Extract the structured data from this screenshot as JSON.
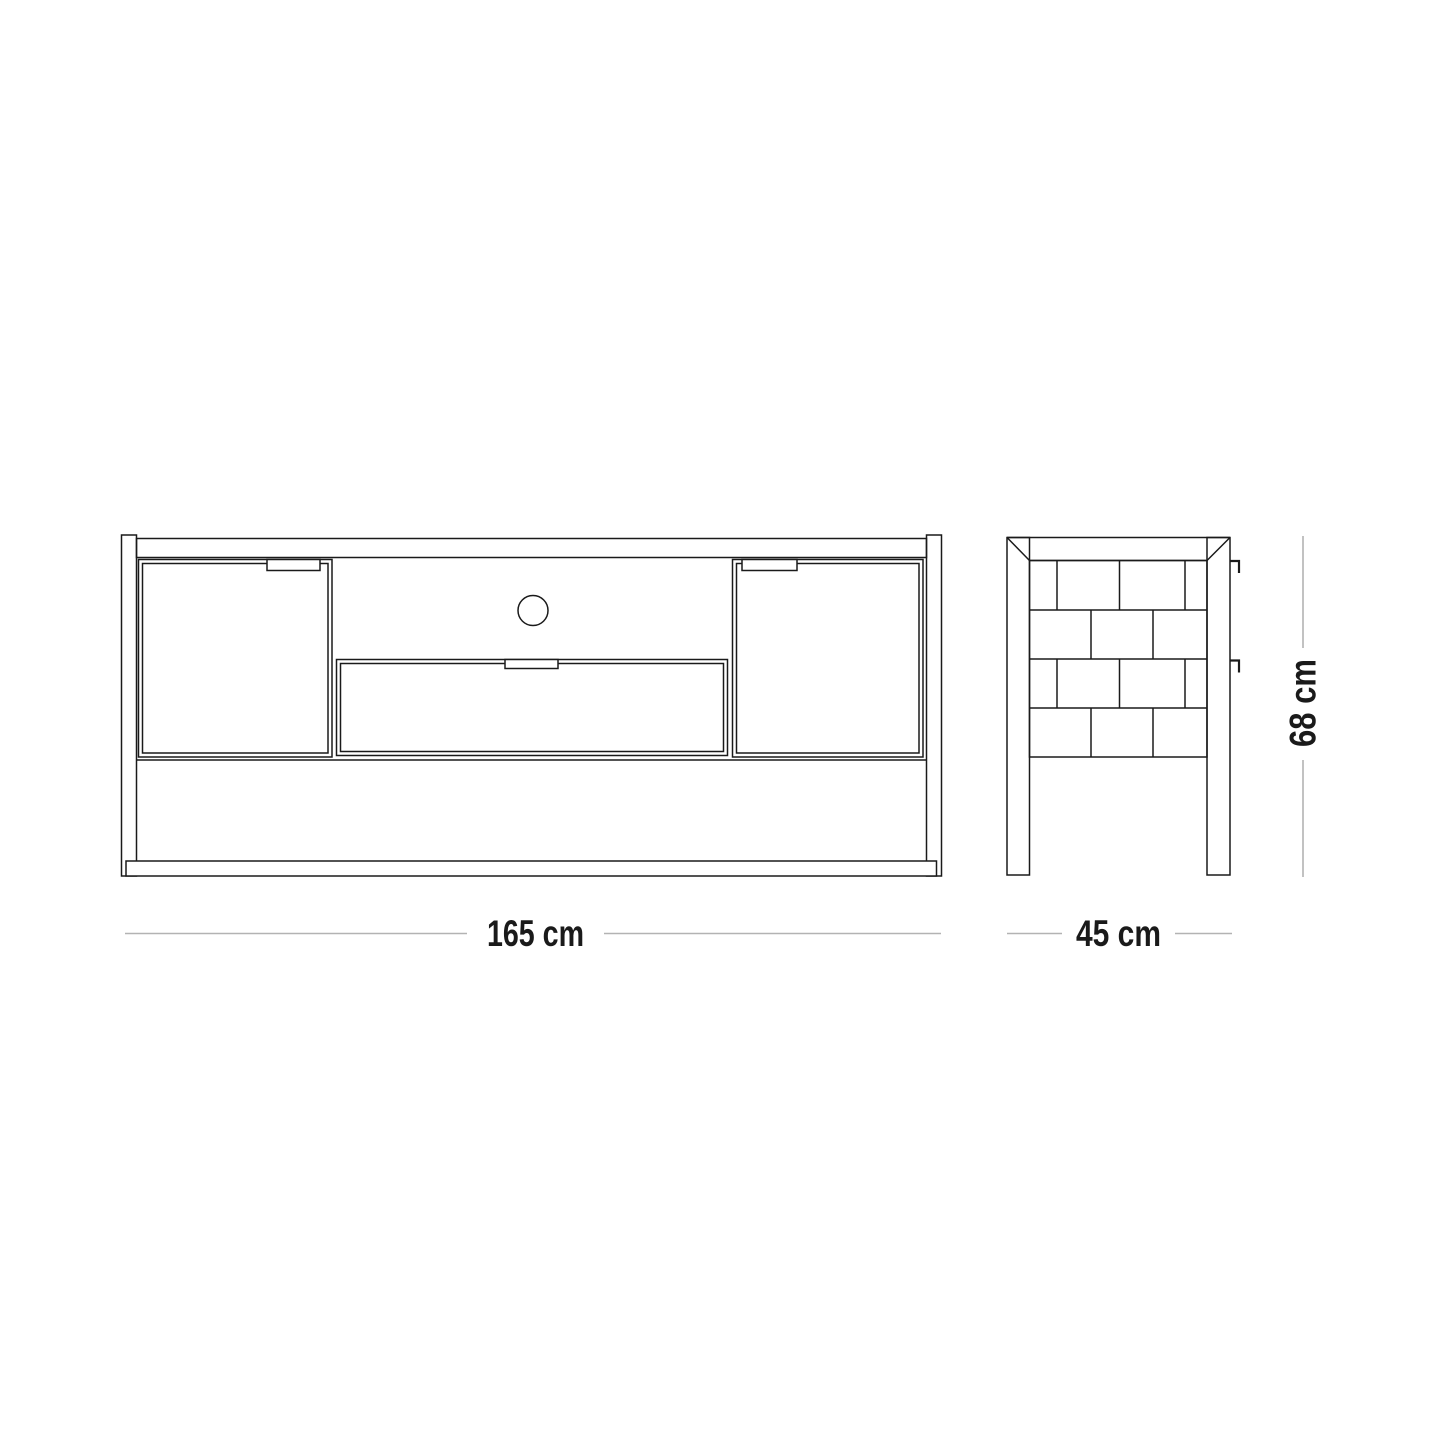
{
  "page": {
    "background": "#ffffff",
    "description_label": "furniture-technical-drawing"
  },
  "colors": {
    "line": "#1a1a1a",
    "dimension_line": "#b3b3b3",
    "text": "#1a1a1a",
    "background": "#ffffff"
  },
  "dimensions": {
    "front_width": {
      "label": "165 cm"
    },
    "side_depth": {
      "label": "45 cm"
    },
    "side_height": {
      "label": "68 cm"
    }
  }
}
